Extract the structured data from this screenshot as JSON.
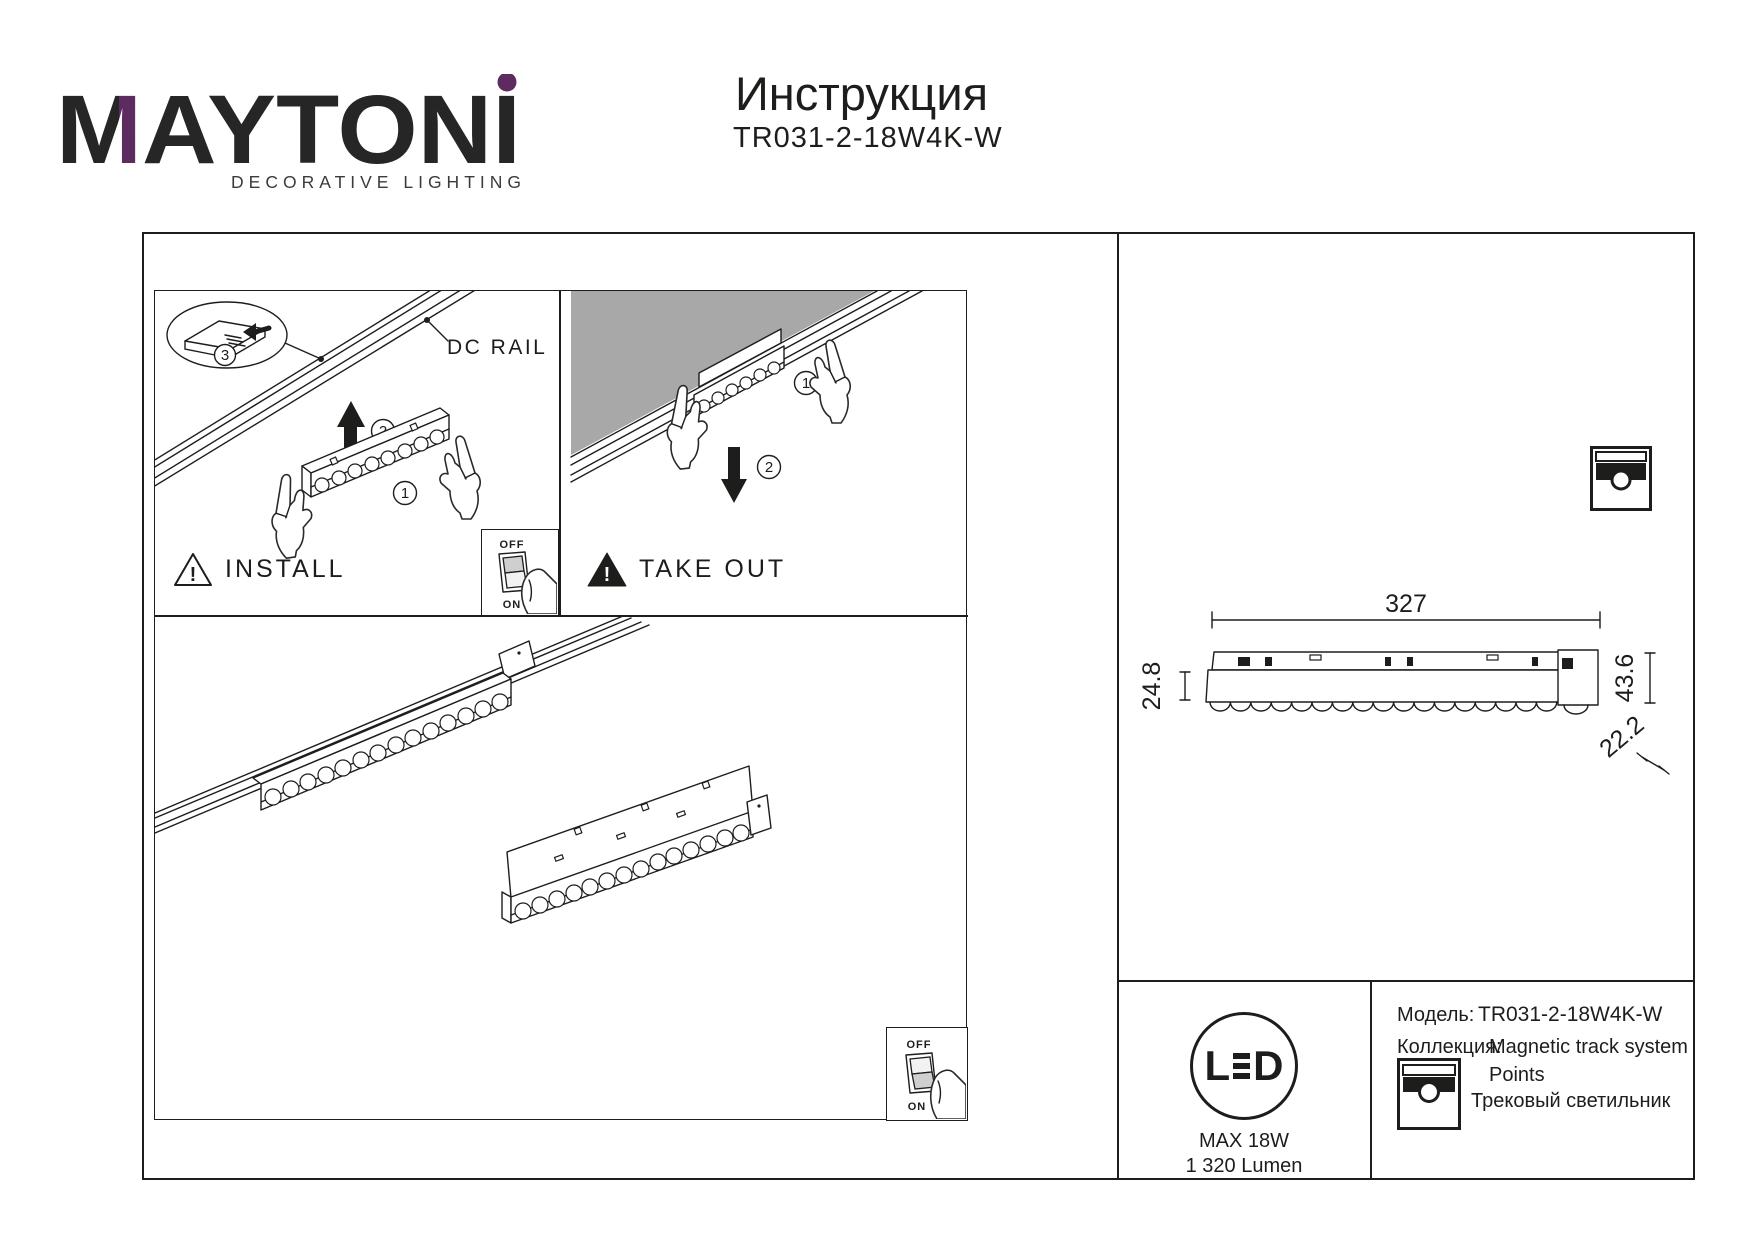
{
  "colors": {
    "ink": "#1d1d1b",
    "purple": "#5e2b60",
    "ceiling_gray": "#a8a8a8"
  },
  "header": {
    "brand_m": "M",
    "brand_rest": "AYTONI",
    "tagline": "DECORATIVE LIGHTING",
    "title": "Инструкция",
    "model": "TR031-2-18W4K-W"
  },
  "install": {
    "label": "INSTALL",
    "dc_rail": "DC RAIL",
    "warning_mark": "!",
    "steps": [
      "1",
      "2",
      "3"
    ]
  },
  "takeout": {
    "label": "TAKE OUT",
    "warning_mark": "!",
    "steps": [
      "1",
      "2"
    ]
  },
  "switch": {
    "off": "OFF",
    "on": "ON"
  },
  "dims": {
    "length": "327",
    "body_height": "24.8",
    "total_height": "43.6",
    "depth": "22.2"
  },
  "info": {
    "led_l": "L",
    "led_d": "D",
    "max_power": "MAX 18W",
    "lumens": "1 320 Lumen",
    "model_label": "Модель:",
    "model_value": "TR031-2-18W4K-W",
    "collection_label": "Коллекция:",
    "collection_value": "Magnetic track system",
    "collection_name": "Points",
    "product_type": "Трековый светильник"
  }
}
